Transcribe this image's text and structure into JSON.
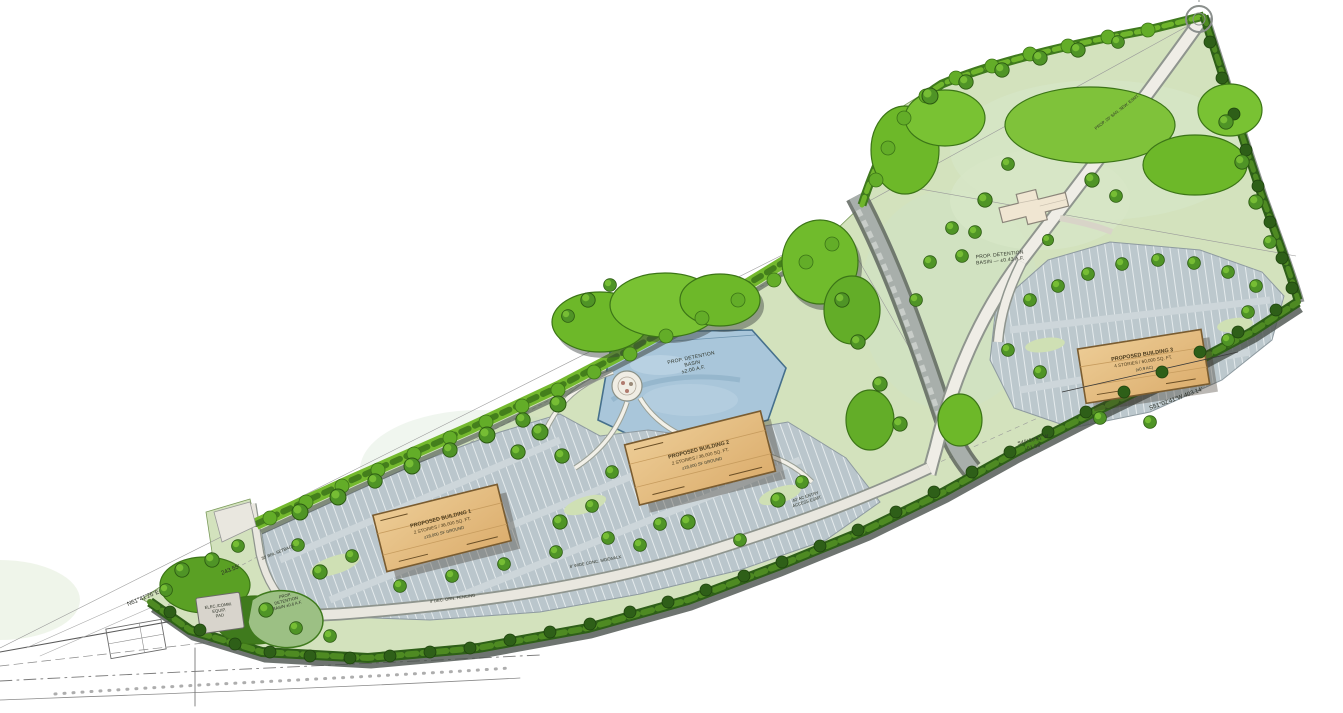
{
  "labels": {
    "building1": {
      "l1": "PROPOSED BUILDING 1",
      "l2": "2 STORIES / 36,000 SQ. FT.",
      "l3": "±18,000 SF GROUND"
    },
    "building2": {
      "l1": "PROPOSED BUILDING 2",
      "l2": "2 STORIES / 36,000 SQ. FT.",
      "l3": "±18,000 SF GROUND"
    },
    "building3": {
      "l1": "PROPOSED BUILDING 3",
      "l2": "4 STORIES / 60,000 SQ. FT.",
      "l3": "(±0.9 AC)"
    },
    "pond_main": {
      "l1": "PROP. DETENTION",
      "l2": "BASIN",
      "l3": "±2.00 A.F."
    },
    "basin_upper": {
      "l1": "PROP. DETENTION",
      "l2": "BASIN — ±0.43 A.F."
    },
    "basin_left": {
      "l1": "PROP.",
      "l2": "DETENTION",
      "l3": "BASIN ±0.6 A.F."
    },
    "equip_pad": {
      "l1": "ELEC./COMM.",
      "l2": "EQUIP.",
      "l3": "PAD"
    },
    "bearing_sw": {
      "bearing": "N61°41'26\"E",
      "dist": "243.55'"
    },
    "bearing_se": {
      "text": "S51°02'41\"W   403.14'"
    },
    "bearing_mid": {
      "l1": "S49°20'51\"W",
      "l2": "61.85'"
    },
    "setback": "30' BRL SETBACK",
    "sewer": "PROP. 20' SAN. SEW. ESMT.",
    "access": {
      "l1": "40' AC ENTRY",
      "l2": "ACCESS ESMT."
    },
    "sidewalk": "8' WIDE CONC. SIDEWALK",
    "fencing": "4' DEC. ORN. FENCING"
  },
  "colors": {
    "lawn": "#d3e2bd",
    "lawn_upper": "#cfe3c8",
    "tree_bright": "#6db829",
    "hedge_dark": "#2e5f18",
    "parking": "#bac6cc",
    "building_tan": "#e6bf85",
    "pond_blue": "#a9c6da",
    "road": "#edebe3",
    "shadow": "#4a514c",
    "house": "#f0e6d2"
  }
}
